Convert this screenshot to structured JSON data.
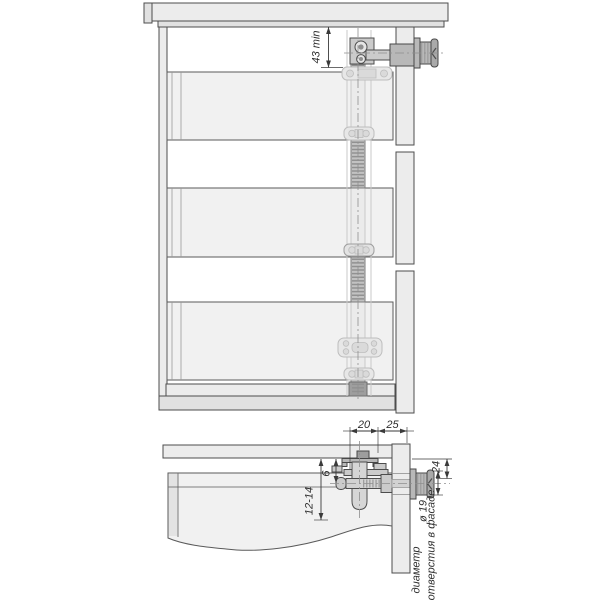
{
  "diagram": {
    "upper_view": {
      "dim_top_min": "43 min"
    },
    "lower_view": {
      "dim_20": "20",
      "dim_25": "25",
      "dim_6": "6",
      "dim_12_14": "12-14",
      "dim_24": "24",
      "dim_hole": "ø 19",
      "caption_word1": "диаметр",
      "caption_word2": "отверстия в фасаде"
    },
    "colors": {
      "background": "#ffffff",
      "panel_fill": "#ececec",
      "metal_fill": "#b8b8b8",
      "ghost_stroke": "#bdbdbd",
      "outline": "#4d4d4d",
      "dimension_text": "#2e2e2e"
    }
  }
}
